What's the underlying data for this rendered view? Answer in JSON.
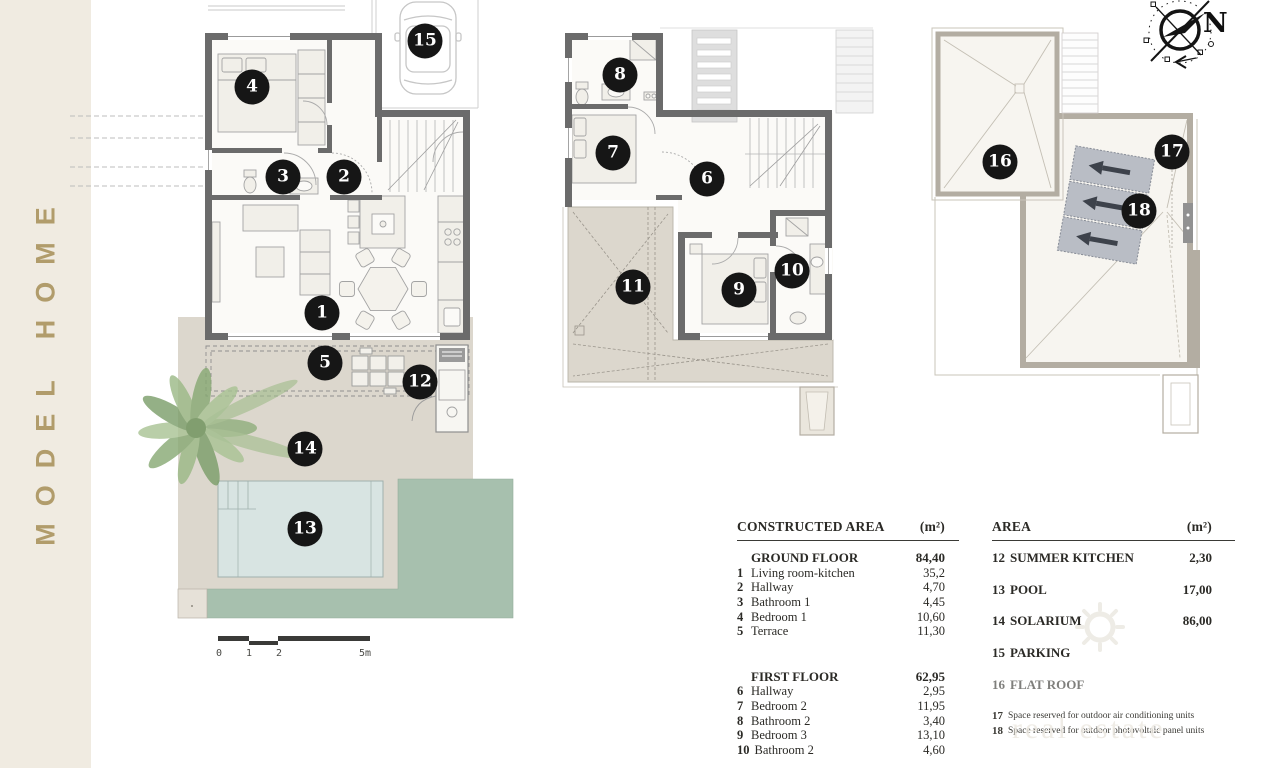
{
  "sidebar": {
    "title": "MODEL HOME",
    "band_color": "#f0ebe1",
    "text_color": "#b19c6b"
  },
  "compass": {
    "north_label": "N"
  },
  "scale_bar": {
    "labels": [
      {
        "text": "0",
        "x": 1
      },
      {
        "text": "1",
        "x": 31
      },
      {
        "text": "2",
        "x": 61
      },
      {
        "text": "5m",
        "x": 147
      }
    ]
  },
  "markers": [
    {
      "n": "1",
      "x": 322,
      "y": 313
    },
    {
      "n": "2",
      "x": 344,
      "y": 177
    },
    {
      "n": "3",
      "x": 283,
      "y": 177
    },
    {
      "n": "4",
      "x": 252,
      "y": 87
    },
    {
      "n": "5",
      "x": 325,
      "y": 363
    },
    {
      "n": "6",
      "x": 707,
      "y": 179
    },
    {
      "n": "7",
      "x": 613,
      "y": 153
    },
    {
      "n": "8",
      "x": 620,
      "y": 75
    },
    {
      "n": "9",
      "x": 739,
      "y": 290
    },
    {
      "n": "10",
      "x": 792,
      "y": 271
    },
    {
      "n": "11",
      "x": 633,
      "y": 287
    },
    {
      "n": "12",
      "x": 420,
      "y": 382
    },
    {
      "n": "13",
      "x": 305,
      "y": 529
    },
    {
      "n": "14",
      "x": 305,
      "y": 449
    },
    {
      "n": "15",
      "x": 425,
      "y": 41
    },
    {
      "n": "16",
      "x": 1000,
      "y": 162
    },
    {
      "n": "17",
      "x": 1172,
      "y": 152
    },
    {
      "n": "18",
      "x": 1139,
      "y": 211
    }
  ],
  "legend_left": {
    "header": "CONSTRUCTED AREA",
    "unit": "(m²)",
    "rows": [
      {
        "num": "",
        "label": "GROUND FLOOR",
        "value": "84,40",
        "cls": "section"
      },
      {
        "num": "1",
        "label": "Living room-kitchen",
        "value": "35,2"
      },
      {
        "num": "2",
        "label": "Hallway",
        "value": "4,70"
      },
      {
        "num": "3",
        "label": "Bathroom 1",
        "value": "4,45"
      },
      {
        "num": "4",
        "label": "Bedroom 1",
        "value": "10,60"
      },
      {
        "num": "5",
        "label": "Terrace",
        "value": "11,30"
      },
      {
        "cls": "spacer"
      },
      {
        "num": "",
        "label": "FIRST FLOOR",
        "value": "62,95",
        "cls": "section"
      },
      {
        "num": "6",
        "label": "Hallway",
        "value": "2,95"
      },
      {
        "num": "7",
        "label": "Bedroom 2",
        "value": "11,95"
      },
      {
        "num": "8",
        "label": "Bathroom 2",
        "value": "3,40"
      },
      {
        "num": "9",
        "label": "Bedroom 3",
        "value": "13,10"
      },
      {
        "num": "10",
        "label": "Bathroom 2",
        "value": "4,60"
      }
    ]
  },
  "legend_right": {
    "header": "AREA",
    "unit": "(m²)",
    "rows": [
      {
        "num": "12",
        "label": "SUMMER KITCHEN",
        "value": "2,30",
        "cls": "big"
      },
      {
        "num": "13",
        "label": "POOL",
        "value": "17,00",
        "cls": "big"
      },
      {
        "num": "14",
        "label": "SOLARIUM",
        "value": "86,00",
        "cls": "big"
      },
      {
        "num": "15",
        "label": "PARKING",
        "value": "",
        "cls": "big"
      },
      {
        "num": "16",
        "label": "FLAT ROOF",
        "value": "",
        "cls": "big"
      },
      {
        "num": "17",
        "label": "Space reserved for outdoor air conditioning units",
        "value": "",
        "cls": "note"
      },
      {
        "num": "18",
        "label": "Space reserved for outdoor photovoltaic panel units",
        "value": "",
        "cls": "note"
      }
    ]
  },
  "watermark": {
    "icon": "sun-icon",
    "text": "real estate"
  },
  "colors": {
    "wall": "#6b6b6b",
    "roof_wall": "#b3ada2",
    "garden": "#dcd7cd",
    "pool": "#d8e4e2",
    "lawn": "#a7c0ae",
    "marker": "#161616",
    "band": "#f0ebe1",
    "gold": "#b19c6b",
    "panel": "#b9bdc5"
  }
}
